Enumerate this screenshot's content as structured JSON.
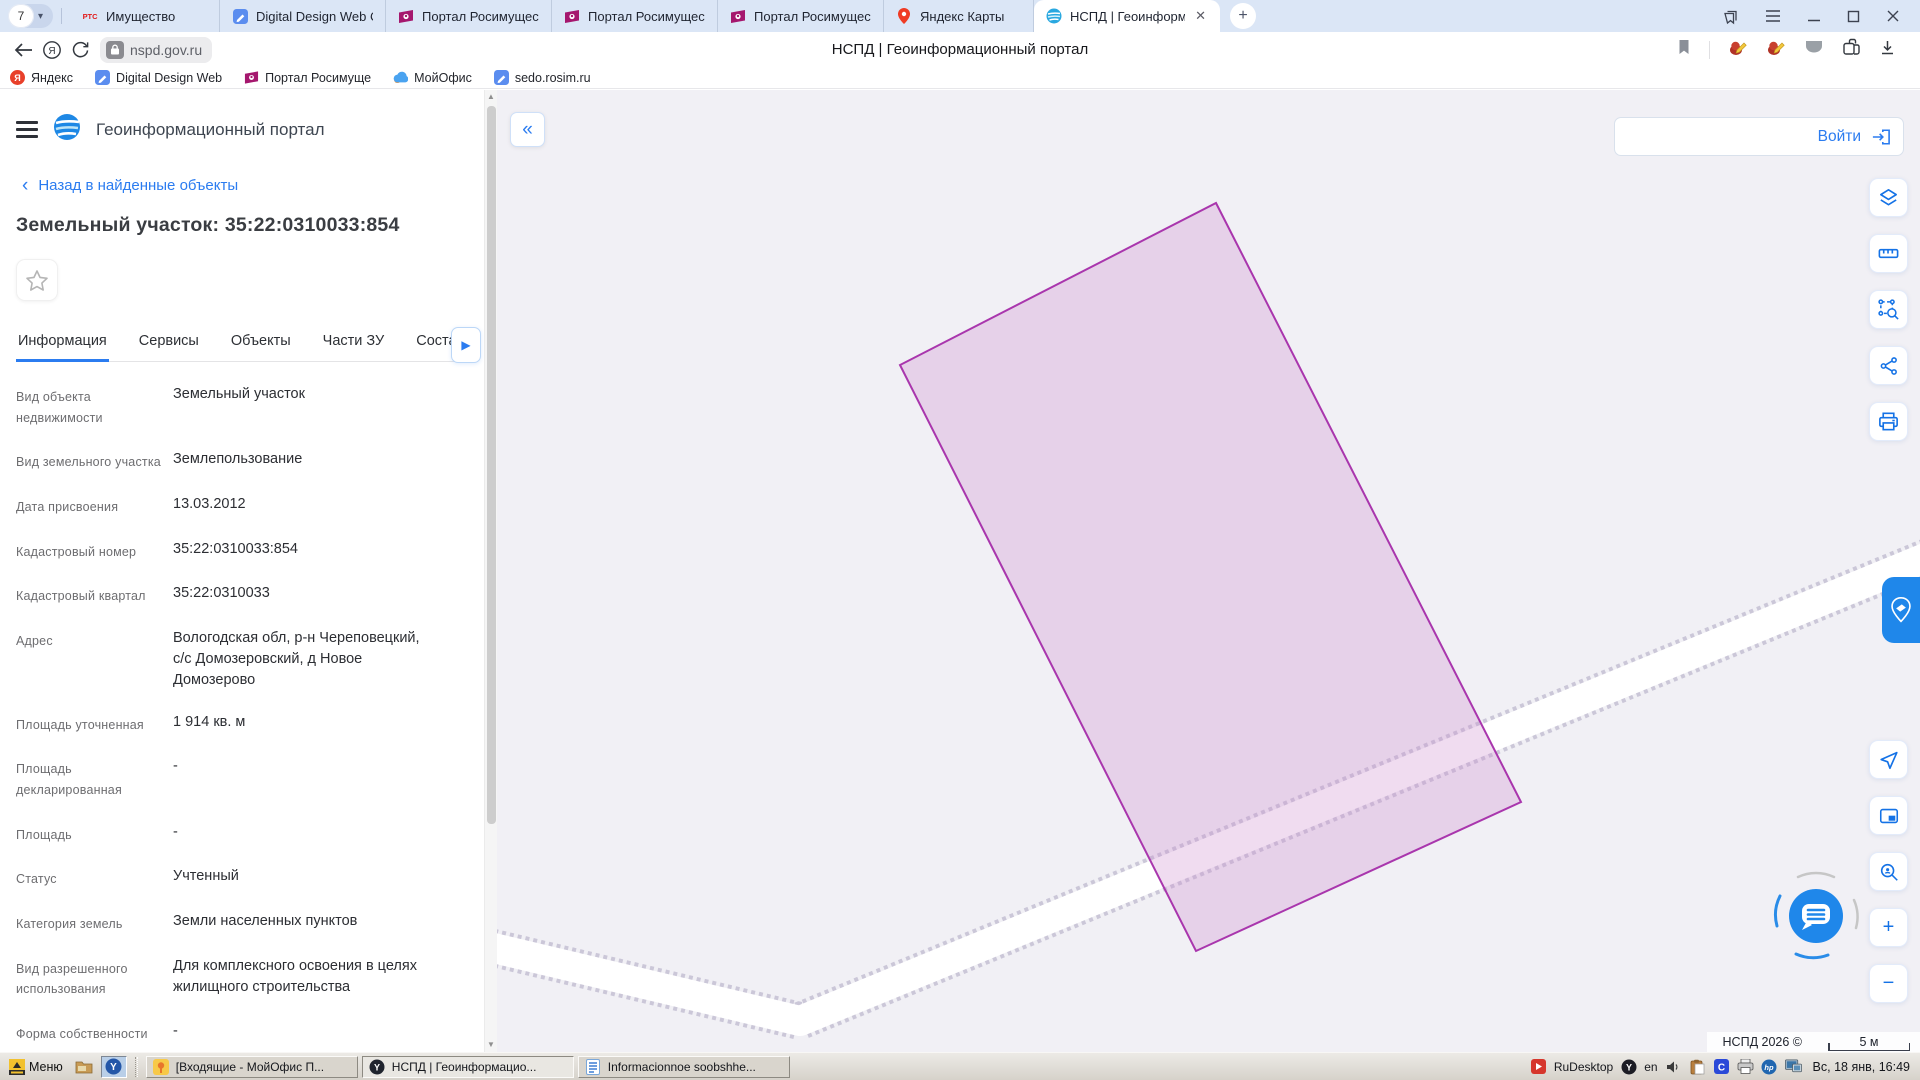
{
  "browser": {
    "tab_counter": "7",
    "tabs": [
      {
        "label": "Имущество",
        "icon": "rts-logo",
        "active": false
      },
      {
        "label": "Digital Design Web Client",
        "icon": "pencil-doc",
        "active": false
      },
      {
        "label": "Портал Росимущества",
        "icon": "rosim-flag",
        "active": false
      },
      {
        "label": "Портал Росимущества",
        "icon": "rosim-flag",
        "active": false
      },
      {
        "label": "Портал Росимущества",
        "icon": "rosim-flag",
        "active": false
      },
      {
        "label": "Яндекс Карты",
        "icon": "map-pin",
        "active": false
      },
      {
        "label": "НСПД | Геоинформаци",
        "icon": "nspd-logo",
        "active": true
      }
    ],
    "url": "nspd.gov.ru",
    "page_title": "НСПД | Геоинформационный портал",
    "bookmarks": [
      {
        "label": "Яндекс",
        "icon": "yandex-logo"
      },
      {
        "label": "Digital Design Web",
        "icon": "pencil-doc"
      },
      {
        "label": "Портал Росимуще",
        "icon": "rosim-flag"
      },
      {
        "label": "МойОфис",
        "icon": "myoffice-cloud"
      },
      {
        "label": "sedo.rosim.ru",
        "icon": "pencil-doc"
      }
    ]
  },
  "panel": {
    "app_title": "Геоинформационный портал",
    "back_link": "Назад в найденные объекты",
    "object_title": "Земельный участок: 35:22:0310033:854",
    "tabs": [
      {
        "label": "Информация",
        "active": true
      },
      {
        "label": "Сервисы",
        "active": false
      },
      {
        "label": "Объекты",
        "active": false
      },
      {
        "label": "Части ЗУ",
        "active": false
      },
      {
        "label": "Соста",
        "active": false
      }
    ],
    "fields": [
      {
        "label": "Вид объекта недвижимости",
        "value": "Земельный участок"
      },
      {
        "label": "Вид земельного участка",
        "value": "Землепользование"
      },
      {
        "label": "Дата присвоения",
        "value": "13.03.2012"
      },
      {
        "label": "Кадастровый номер",
        "value": "35:22:0310033:854"
      },
      {
        "label": "Кадастровый квартал",
        "value": "35:22:0310033"
      },
      {
        "label": "Адрес",
        "value": "Вологодская обл, р-н Череповецкий, с/с Домозеровский, д Новое Домозерово"
      },
      {
        "label": "Площадь уточненная",
        "value": "1 914 кв. м"
      },
      {
        "label": "Площадь декларированная",
        "value": "-"
      },
      {
        "label": "Площадь",
        "value": "-"
      },
      {
        "label": "Статус",
        "value": "Учтенный"
      },
      {
        "label": "Категория земель",
        "value": "Земли населенных пунктов"
      },
      {
        "label": "Вид разрешенного использования",
        "value": "Для комплексного освоения в целях жилищного строительства"
      },
      {
        "label": "Форма собственности",
        "value": "-"
      }
    ]
  },
  "map": {
    "login_label": "Войти",
    "attribution": "НСПД 2026 ©",
    "scale_label": "5 м",
    "parcel": {
      "stroke_color": "#a936ad",
      "fill_color": "rgba(206,138,206,0.30)",
      "points": "719,113 1024,712 699,861 403,275"
    },
    "road_path": "M -100 835 L 303 931 L 1460 455"
  },
  "taskbar": {
    "menu_label": "Меню",
    "apps": [
      {
        "label": "[Входящие - МойОфис П...",
        "icon": "myoffice-pin",
        "active": false
      },
      {
        "label": "НСПД | Геоинформацио...",
        "icon": "yandex-browser",
        "active": true
      },
      {
        "label": "Informacionnoe soobshhe...",
        "icon": "doc-blue",
        "active": false
      }
    ],
    "tray": {
      "rudesktop": "RuDesktop",
      "lang": "en",
      "clock": "Вс, 18 янв, 16:49"
    }
  }
}
